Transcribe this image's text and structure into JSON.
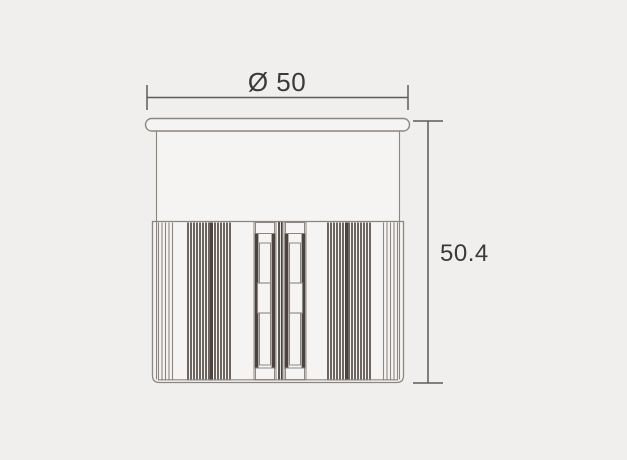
{
  "drawing": {
    "type": "technical-dimension-drawing",
    "subject": "cylindrical recessed luminaire side view",
    "diameter_label": "Ø 50",
    "height_label": "50.4"
  },
  "colors": {
    "background": "#f0efed",
    "surface": "#f5f4f2",
    "outline": "#8b8682",
    "dark_fill": "#4a433f",
    "dimension_line": "#5d5c5a",
    "text": "#3a3a3a"
  }
}
